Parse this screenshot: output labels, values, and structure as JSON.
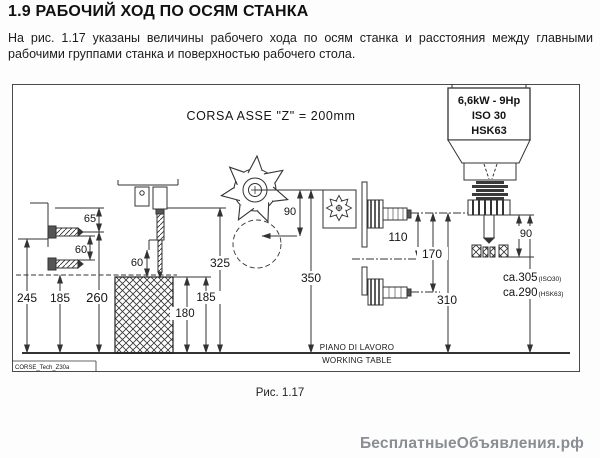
{
  "page": {
    "heading": "1.9 РАБОЧИЙ ХОД ПО ОСЯМ СТАНКА",
    "intro_line1": "На рис. 1.17 указаны величины рабочего хода по осям станка и расстояния между главными",
    "intro_line2": "рабочими группами станка и поверхностью рабочего стола.",
    "caption": "Рис. 1.17",
    "watermark": "БесплатныеОбъявления.рф"
  },
  "diagram": {
    "title": "CORSA ASSE \"Z\" = 200mm",
    "spindle_label": {
      "power": "6,6kW - 9Hp",
      "taper1": "ISO 30",
      "taper2": "HSK63"
    },
    "working_table": {
      "it": "PIANO DI LAVORO",
      "en": "WORKING TABLE"
    },
    "drawing_code": "CORSE_Tech_Z30a",
    "dims": {
      "bracket_to_drill": "65",
      "drill_spacing": "60",
      "upper_drill_height": "245",
      "lower_drill_height": "185",
      "head_height": "260",
      "vert_drill_stroke": "60",
      "vert_head_height": "325",
      "workpiece_height": "180",
      "workpiece_ref_height": "185",
      "saw_radius": "90",
      "saw_height": "350",
      "router_spacing": "110",
      "router_lower": "170",
      "router_height": "310",
      "spindle_tool": "90"
    },
    "clearance": {
      "iso_value": "ca.305",
      "iso_sub": "(ISO30)",
      "hsk_value": "ca.290",
      "hsk_sub": "(HSK63)"
    }
  }
}
